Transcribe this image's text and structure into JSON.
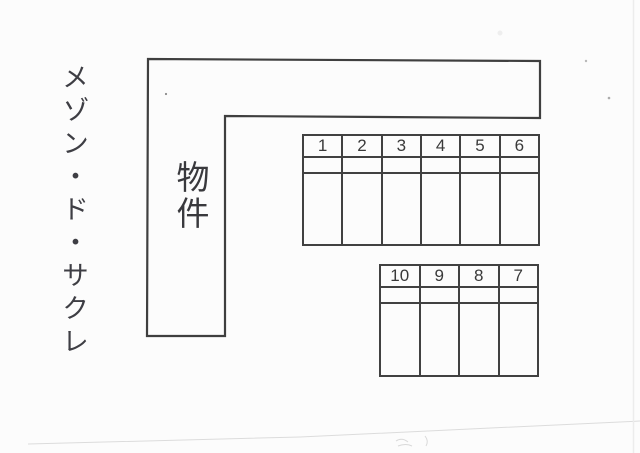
{
  "page": {
    "property_name": "メゾン・ド・サクレ",
    "building_label": "物件"
  },
  "parking": {
    "row_top": {
      "numbers": [
        "1",
        "2",
        "3",
        "4",
        "5",
        "6"
      ]
    },
    "row_bottom": {
      "numbers": [
        "10",
        "9",
        "8",
        "7"
      ]
    }
  },
  "colors": {
    "ink": "#3f3f3f",
    "grid_line": "#414141",
    "scan_artifact": "#dcdcdc",
    "paper": "#fcfcfc"
  }
}
